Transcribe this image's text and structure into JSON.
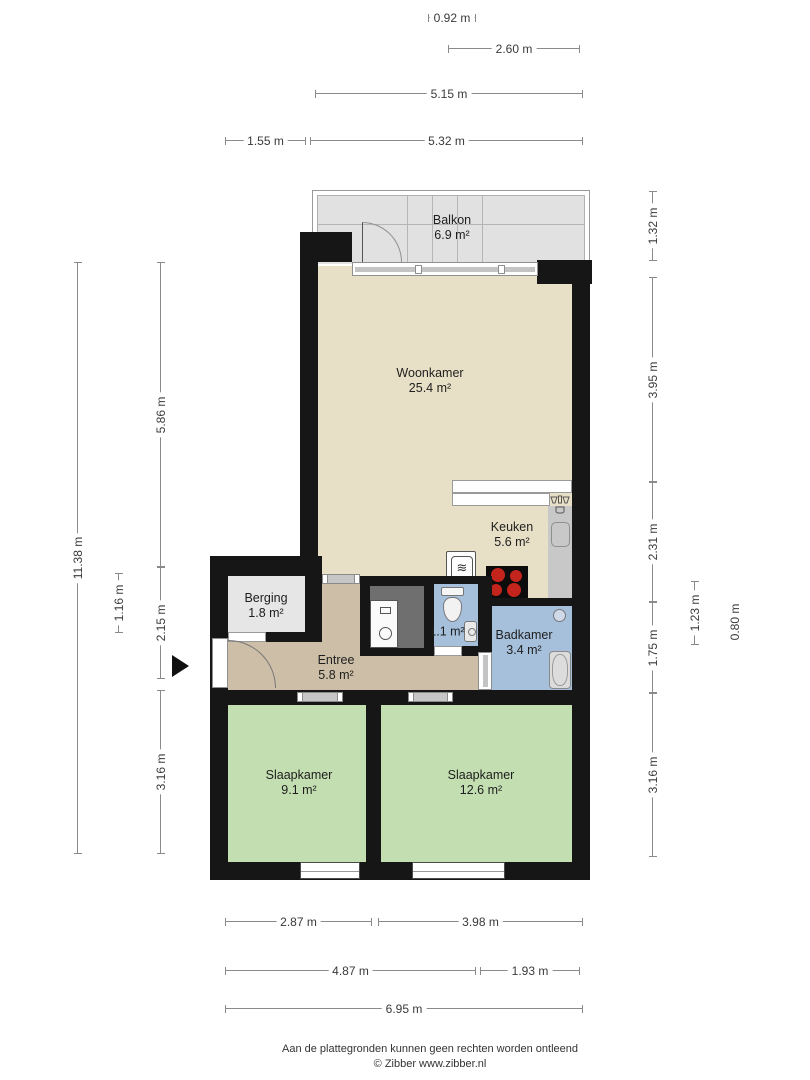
{
  "rooms": {
    "balkon": {
      "name": "Balkon",
      "area": "6.9 m²"
    },
    "woonkamer": {
      "name": "Woonkamer",
      "area": "25.4 m²"
    },
    "keuken": {
      "name": "Keuken",
      "area": "5.6 m²"
    },
    "berging": {
      "name": "Berging",
      "area": "1.8 m²"
    },
    "entree": {
      "name": "Entree",
      "area": "5.8 m²"
    },
    "toilet": {
      "area": "1.1 m²"
    },
    "badkamer": {
      "name": "Badkamer",
      "area": "3.4 m²"
    },
    "slaapkamer_links": {
      "name": "Slaapkamer",
      "area": "9.1 m²"
    },
    "slaapkamer_rechts": {
      "name": "Slaapkamer",
      "area": "12.6 m²"
    }
  },
  "dimensions": {
    "top": [
      "0.92 m",
      "2.60 m",
      "5.15 m",
      "1.55 m",
      "5.32 m"
    ],
    "bottom": [
      "2.87 m",
      "3.98 m",
      "4.87 m",
      "1.93 m",
      "6.95 m"
    ],
    "left": [
      "11.38 m",
      "5.86 m",
      "1.16 m",
      "2.15 m",
      "3.16 m"
    ],
    "right": [
      "1.32 m",
      "3.95 m",
      "2.31 m",
      "1.75 m",
      "3.16 m",
      "1.23 m",
      "0.80 m"
    ]
  },
  "footer": {
    "disclaimer": "Aan de plattegronden kunnen geen rechten worden ontleend",
    "credit": "© Zibber www.zibber.nl"
  },
  "icons": {
    "oven_glyph": "≋"
  },
  "colors": {
    "wall": "#161616",
    "living": "#e7dfc6",
    "hall": "#cdbfa7",
    "storage": "#e6e6e6",
    "wet": "#a6c0dc",
    "bedroom": "#c3deb1",
    "balcony": "#e1e1e1",
    "closet": "#6f6f6f",
    "counter": "#c8c8c8",
    "burner": "#c3241b"
  }
}
